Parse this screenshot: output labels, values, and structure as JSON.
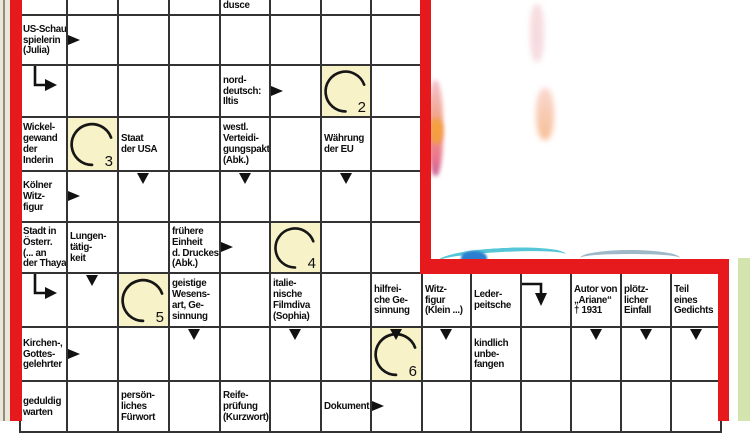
{
  "puzzle_type": "schwedenraetsel-crossword-clip",
  "language": "de",
  "colors": {
    "red_border": "#e61a1c",
    "grid_line": "#333333",
    "circle_cell_bg": "#f7f2c8",
    "page_margin_beige": "#ece7d8",
    "page_green_strip": "#d4e4ae",
    "photo_teal": "#55c6d8",
    "photo_blue": "#2b7fd0"
  },
  "grid": {
    "columns": 14,
    "rows": 9
  },
  "solution_circle_numbers_visible": [
    "2",
    "3",
    "4",
    "5",
    "6"
  ],
  "cells": [
    {
      "col": 5,
      "row": 1,
      "type": "clue",
      "clip": "top",
      "lines": [
        "dusce"
      ]
    },
    {
      "col": 1,
      "row": 2,
      "type": "clue",
      "lines": [
        "US-Schau-",
        "spielerin",
        "(Julia)"
      ]
    },
    {
      "col": 2,
      "row": 2,
      "arrow": "right"
    },
    {
      "col": 1,
      "row": 3,
      "arrow": "elbow-down-right"
    },
    {
      "col": 5,
      "row": 3,
      "type": "clue",
      "lines": [
        "nord-",
        "deutsch:",
        "Iltis"
      ]
    },
    {
      "col": 6,
      "row": 3,
      "arrow": "right"
    },
    {
      "col": 7,
      "row": 3,
      "type": "circle",
      "label": "2"
    },
    {
      "col": 1,
      "row": 4,
      "type": "clue",
      "lines": [
        "Wickel-",
        "gewand",
        "der",
        "Inderin"
      ]
    },
    {
      "col": 2,
      "row": 4,
      "type": "circle",
      "label": "3"
    },
    {
      "col": 3,
      "row": 4,
      "type": "clue",
      "lines": [
        "Staat",
        "der USA"
      ]
    },
    {
      "col": 5,
      "row": 4,
      "type": "clue",
      "lines": [
        "westl.",
        "Verteidi-",
        "gungspakt",
        "(Abk.)"
      ]
    },
    {
      "col": 7,
      "row": 4,
      "type": "clue",
      "lines": [
        "Währung",
        "der EU"
      ]
    },
    {
      "col": 1,
      "row": 5,
      "type": "clue",
      "lines": [
        "Kölner",
        "Witz-",
        "figur"
      ]
    },
    {
      "col": 2,
      "row": 5,
      "arrow": "right"
    },
    {
      "col": 3,
      "row": 5,
      "arrow": "down"
    },
    {
      "col": 5,
      "row": 5,
      "arrow": "down"
    },
    {
      "col": 7,
      "row": 5,
      "arrow": "down"
    },
    {
      "col": 1,
      "row": 6,
      "type": "clue",
      "lines": [
        "Stadt in",
        "Österr.",
        "(... an",
        "der Thaya)"
      ]
    },
    {
      "col": 2,
      "row": 6,
      "type": "clue",
      "lines": [
        "Lungen-",
        "tätig-",
        "keit"
      ]
    },
    {
      "col": 4,
      "row": 6,
      "type": "clue",
      "lines": [
        "frühere",
        "Einheit",
        "d. Druckes",
        "(Abk.)"
      ]
    },
    {
      "col": 5,
      "row": 6,
      "arrow": "right"
    },
    {
      "col": 6,
      "row": 6,
      "type": "circle",
      "label": "4"
    },
    {
      "col": 1,
      "row": 7,
      "arrow": "elbow-down-right"
    },
    {
      "col": 2,
      "row": 7,
      "arrow": "down"
    },
    {
      "col": 3,
      "row": 7,
      "type": "circle",
      "label": "5"
    },
    {
      "col": 4,
      "row": 7,
      "type": "clue",
      "lines": [
        "geistige",
        "Wesens-",
        "art, Ge-",
        "sinnung"
      ]
    },
    {
      "col": 6,
      "row": 7,
      "type": "clue",
      "lines": [
        "italie-",
        "nische",
        "Filmdiva",
        "(Sophia)"
      ]
    },
    {
      "col": 8,
      "row": 7,
      "type": "clue",
      "lines": [
        "hilfrei-",
        "che Ge-",
        "sinnung"
      ]
    },
    {
      "col": 9,
      "row": 7,
      "type": "clue",
      "lines": [
        "Witz-",
        "figur",
        "(Klein ...)"
      ]
    },
    {
      "col": 10,
      "row": 7,
      "type": "clue",
      "lines": [
        "Leder-",
        "peitsche"
      ]
    },
    {
      "col": 11,
      "row": 7,
      "arrow": "elbow-right-down"
    },
    {
      "col": 12,
      "row": 7,
      "type": "clue",
      "lines": [
        "Autor von",
        "„Ariane“",
        "† 1931"
      ]
    },
    {
      "col": 13,
      "row": 7,
      "type": "clue",
      "lines": [
        "plötz-",
        "licher",
        "Einfall"
      ]
    },
    {
      "col": 14,
      "row": 7,
      "type": "clue",
      "lines": [
        "Teil",
        "eines",
        "Gedichts"
      ]
    },
    {
      "col": 1,
      "row": 8,
      "type": "clue",
      "lines": [
        "Kirchen-,",
        "Gottes-",
        "gelehrter"
      ]
    },
    {
      "col": 2,
      "row": 8,
      "arrow": "right"
    },
    {
      "col": 4,
      "row": 8,
      "arrow": "down"
    },
    {
      "col": 6,
      "row": 8,
      "arrow": "down"
    },
    {
      "col": 8,
      "row": 8,
      "type": "circle",
      "label": "6",
      "arrow": "down"
    },
    {
      "col": 9,
      "row": 8,
      "arrow": "down"
    },
    {
      "col": 10,
      "row": 8,
      "type": "clue",
      "lines": [
        "kindlich",
        "unbe-",
        "fangen"
      ]
    },
    {
      "col": 12,
      "row": 8,
      "arrow": "down"
    },
    {
      "col": 13,
      "row": 8,
      "arrow": "down"
    },
    {
      "col": 14,
      "row": 8,
      "arrow": "down"
    },
    {
      "col": 1,
      "row": 9,
      "type": "clue",
      "lines": [
        "geduldig",
        "warten"
      ]
    },
    {
      "col": 3,
      "row": 9,
      "type": "clue",
      "lines": [
        "persön-",
        "liches",
        "Fürwort"
      ]
    },
    {
      "col": 5,
      "row": 9,
      "type": "clue",
      "lines": [
        "Reife-",
        "prüfung",
        "(Kurzwort)"
      ]
    },
    {
      "col": 7,
      "row": 9,
      "type": "clue",
      "lines": [
        "Dokument"
      ]
    },
    {
      "col": 8,
      "row": 9,
      "arrow": "right"
    }
  ]
}
